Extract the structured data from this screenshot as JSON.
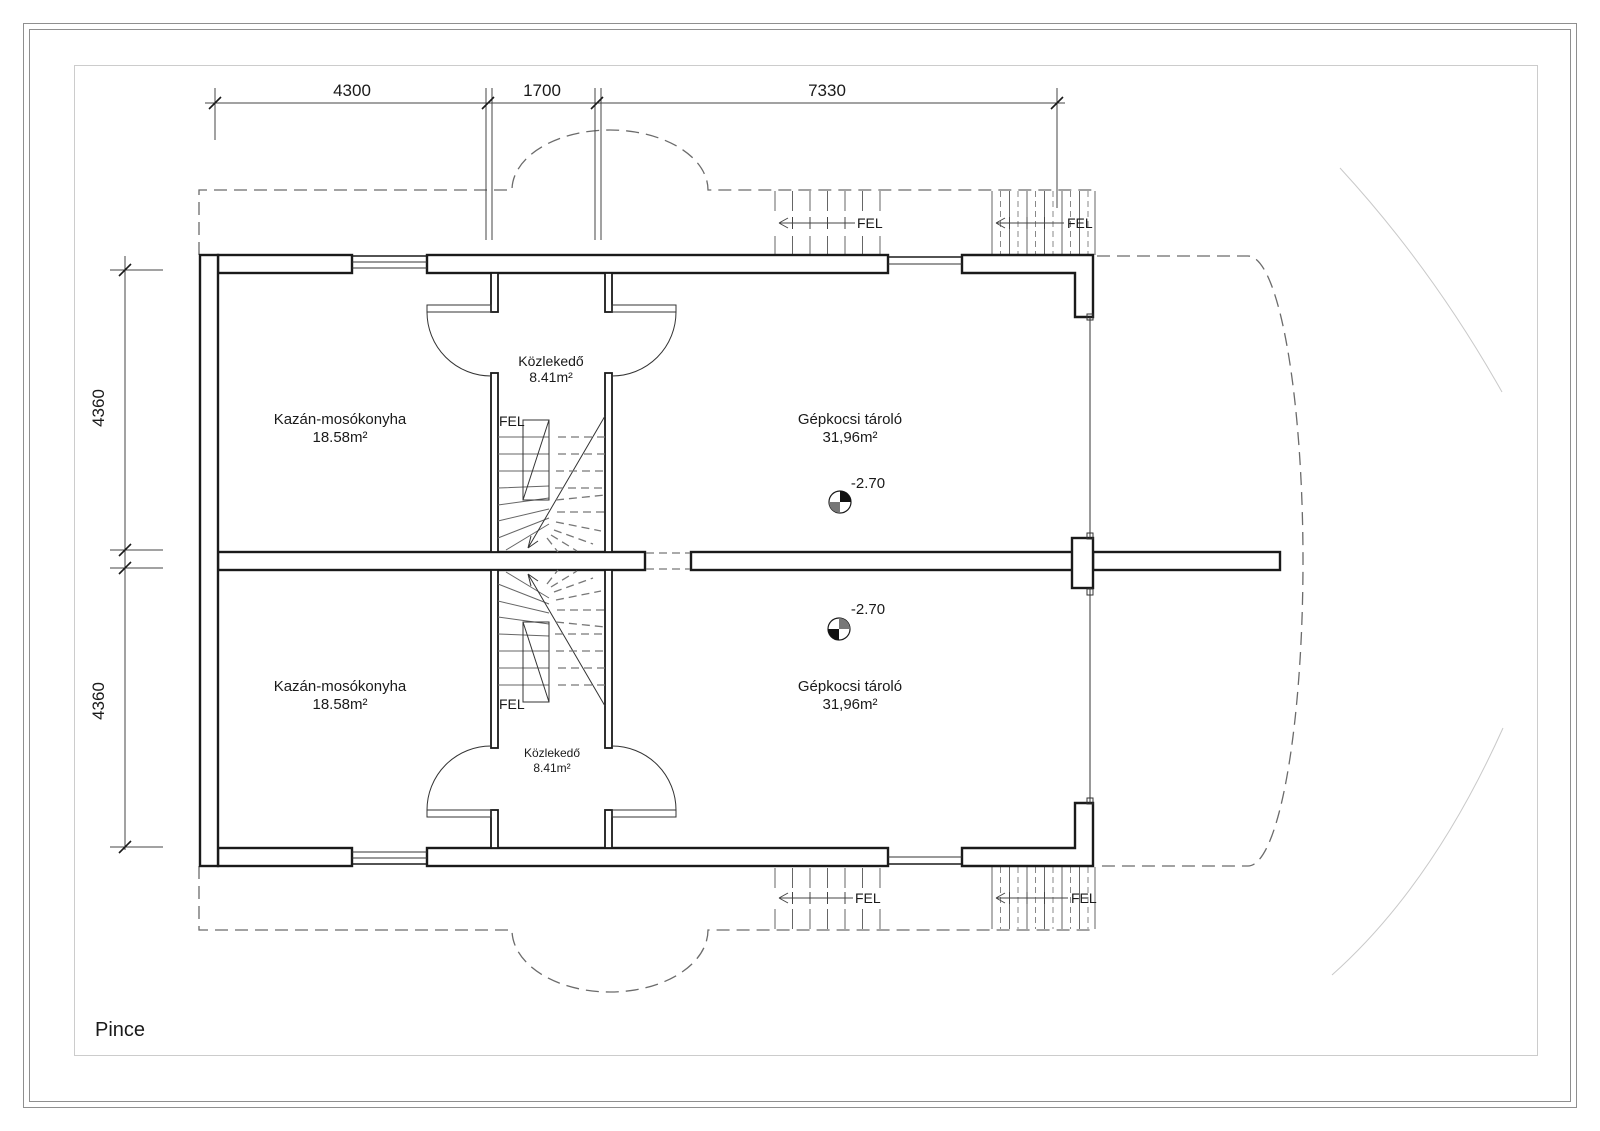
{
  "page": {
    "title": "Pince"
  },
  "colors": {
    "line": "#1a1a1a",
    "dashed_outline": "#6b6b6b",
    "stair_tread": "#666666",
    "faint_arc": "#c9c9c9",
    "frame": "#8f8f8f",
    "inner_border": "#cccccc",
    "background": "#ffffff"
  },
  "dims": {
    "top": [
      {
        "label": "4300"
      },
      {
        "label": "1700"
      },
      {
        "label": "7330"
      }
    ],
    "left": [
      {
        "label": "4360"
      },
      {
        "label": "4360"
      }
    ]
  },
  "stair_label": "FEL",
  "units": {
    "top": {
      "boiler": {
        "name": "Kazán-mosókonyha",
        "area": "18.58m²"
      },
      "hall": {
        "name": "Közlekedő",
        "area": "8.41m²"
      },
      "garage": {
        "name": "Gépkocsi tároló",
        "area": "31,96m²",
        "level": "-2.70"
      }
    },
    "bottom": {
      "boiler": {
        "name": "Kazán-mosókonyha",
        "area": "18.58m²"
      },
      "hall": {
        "name": "Közlekedő",
        "area": "8.41m²"
      },
      "garage": {
        "name": "Gépkocsi tároló",
        "area": "31,96m²",
        "level": "-2.70"
      }
    }
  }
}
